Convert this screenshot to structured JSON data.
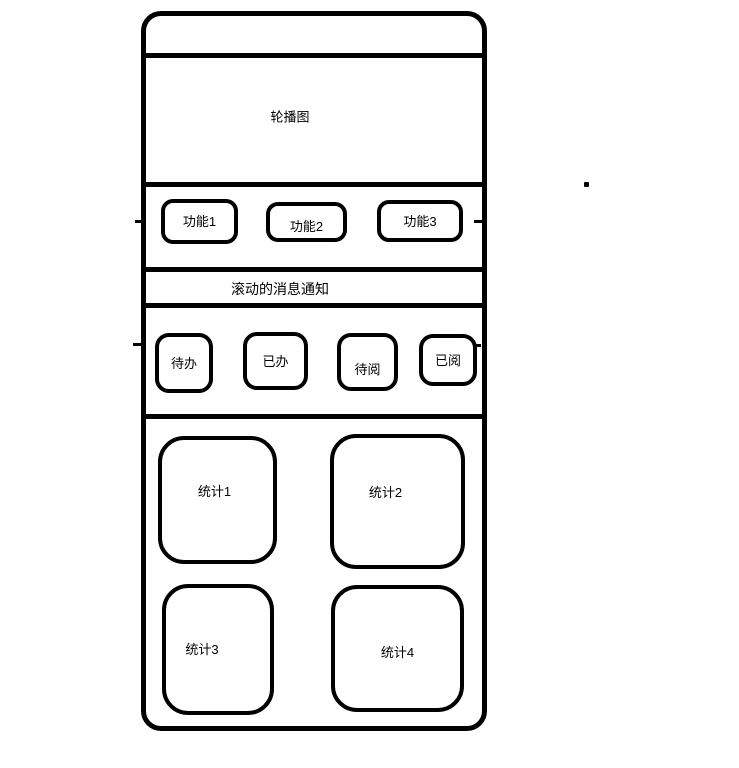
{
  "app": {
    "background": "#ffffff",
    "ink": "#000000"
  },
  "wireframe": {
    "carousel": {
      "label": "轮播图"
    },
    "function_row": {
      "buttons": [
        {
          "label": "功能1"
        },
        {
          "label": "功能2"
        },
        {
          "label": "功能3"
        }
      ]
    },
    "notice_bar": {
      "label": "滚动的消息通知"
    },
    "action_row": {
      "buttons": [
        {
          "label": "待办"
        },
        {
          "label": "已办"
        },
        {
          "label": "待阅"
        },
        {
          "label": "已阅"
        }
      ]
    },
    "stats_grid": {
      "cards": [
        {
          "label": "统计1"
        },
        {
          "label": "统计2"
        },
        {
          "label": "统计3"
        },
        {
          "label": "统计4"
        }
      ]
    }
  }
}
